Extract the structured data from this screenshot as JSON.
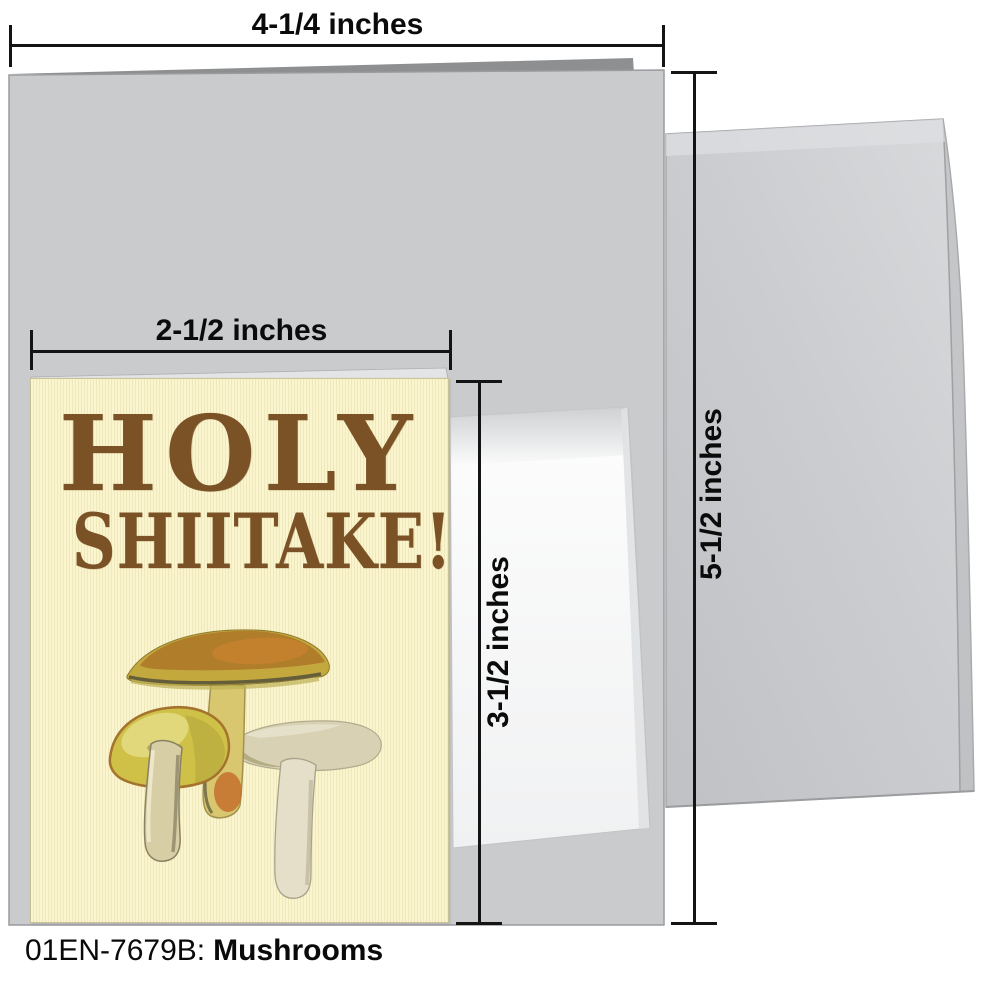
{
  "product": {
    "code": "01EN-7679B:",
    "name": "Mushrooms"
  },
  "card_front": {
    "line1": "HOLY",
    "line2": "SHIITAKE!"
  },
  "measurements": {
    "outer_card_width": "4-1/4 inches",
    "small_card_width": "2-1/2 inches",
    "small_card_height": "3-1/2 inches",
    "outer_card_height": "5-1/2 inches"
  },
  "colors": {
    "card_background": "#FAF5CE",
    "headline_brown": "#7B5226",
    "card_stock_gray": "#C9CBCD",
    "envelope_gray": "#CDCFD2",
    "mini_envelope_white": "#FBFBFB",
    "dimension_line": "#141414"
  },
  "icons": {
    "illustration": "mushroom-illustration"
  }
}
